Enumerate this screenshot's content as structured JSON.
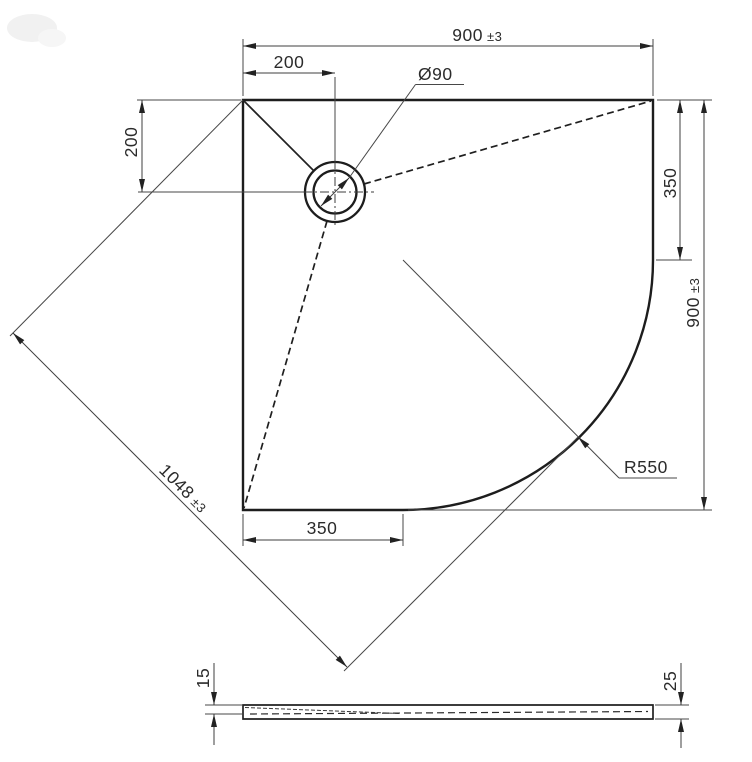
{
  "drawing": {
    "kind": "shower-tray technical drawing, quadrant plan view with side profile",
    "colors": {
      "outline": "#1d1d1d",
      "thin_line": "#474747",
      "text": "#2b2b2b",
      "background": "#ffffff"
    },
    "plan": {
      "width": {
        "value": "900",
        "tolerance": "±3"
      },
      "drain_offset_x": {
        "value": "200"
      },
      "drain_offset_y": {
        "value": "200"
      },
      "drain_diameter": {
        "value": "Ø90"
      },
      "right_straight_edge": {
        "value": "350"
      },
      "height": {
        "value": "900",
        "tolerance": "±3"
      },
      "corner_radius": {
        "value": "R550"
      },
      "diagonal": {
        "value": "1048",
        "tolerance": "±3"
      },
      "bottom_straight_edge": {
        "value": "350"
      }
    },
    "profile": {
      "edge_thickness": {
        "value": "15"
      },
      "overall_height": {
        "value": "25"
      }
    }
  }
}
